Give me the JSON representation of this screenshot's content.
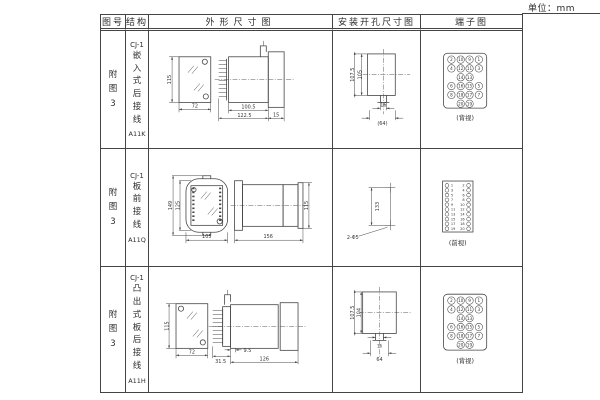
{
  "page": {
    "unit_label": "单位：mm"
  },
  "table": {
    "headers": [
      "图号",
      "结构",
      "外形尺寸图",
      "安装开孔尺寸图",
      "端子图"
    ]
  },
  "rows": [
    {
      "figure_no": "附\n图\n3",
      "model": "CJ-1",
      "structure": "嵌\n入\n式\n后\n接\n线",
      "code": "A11K",
      "outline": {
        "height": "115",
        "width": "72",
        "body_len": "100.5",
        "total_len": "122.5",
        "flange": "15"
      },
      "mounting": {
        "outer_h": "107.5",
        "inner_h": "105",
        "slot_w": "16",
        "ref_w": "(64)"
      },
      "terminal_caption": "(背视)"
    },
    {
      "figure_no": "附\n图\n3",
      "model": "CJ-1",
      "structure": "板\n前\n接\n线",
      "code": "A11Q",
      "outline": {
        "outer_h": "149",
        "inner_h": "125",
        "width": "105",
        "length": "156",
        "height": "115"
      },
      "mounting": {
        "spacing": "133",
        "holes": "2-Φ5"
      },
      "terminal_caption": "(前视)"
    },
    {
      "figure_no": "附\n图\n3",
      "model": "CJ-1",
      "structure": "凸\n出\n式\n板\n后\n接\n线",
      "code": "A11H",
      "outline": {
        "height": "115",
        "width": "72",
        "seg1": "31.5",
        "seg2": "9.5",
        "length": "126"
      },
      "mounting": {
        "outer_h": "107.5",
        "inner_h": "104",
        "slot_w": "16",
        "width": "64"
      },
      "terminal_caption": "(背视)"
    }
  ],
  "back_terminals": {
    "rows": [
      [
        "2",
        "10",
        "9",
        "1"
      ],
      [
        "4",
        "12",
        "11",
        "3"
      ],
      [
        "",
        "14",
        "13",
        ""
      ],
      [
        "6",
        "16",
        "15",
        "5"
      ],
      [
        "8",
        "18",
        "17",
        "7"
      ],
      [
        "",
        "20",
        "19",
        ""
      ]
    ]
  },
  "front_terminals": {
    "left": [
      "1",
      "3",
      "5",
      "7",
      "9",
      "11",
      "13",
      "15",
      "17",
      "19"
    ],
    "right": [
      "2",
      "4",
      "6",
      "8",
      "10",
      "12",
      "14",
      "16",
      "18",
      "20"
    ]
  }
}
